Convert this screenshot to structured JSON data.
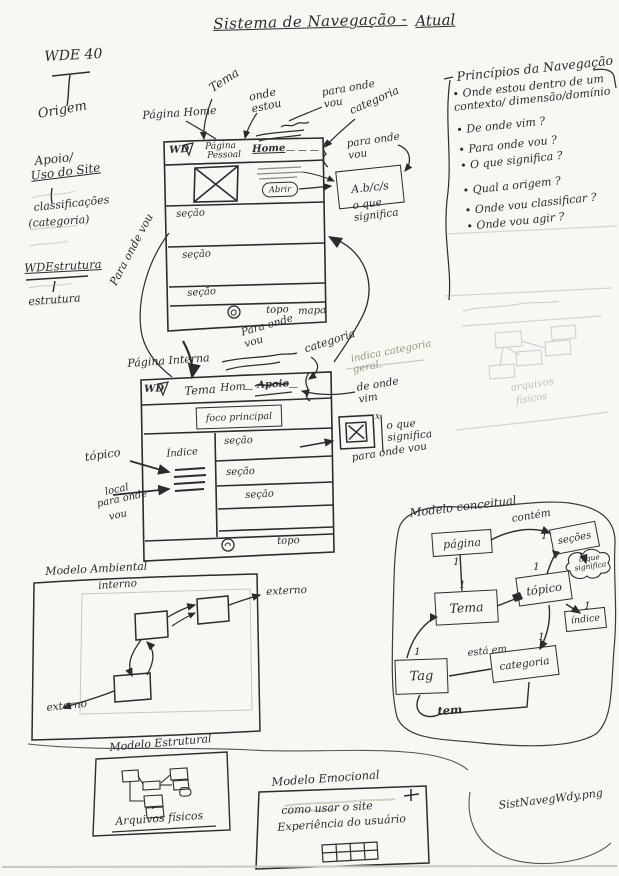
{
  "title": {
    "main": "Sistema de Navegação -",
    "atual": "Atual"
  },
  "left_margin": {
    "wde": "WDE 40",
    "origem": "Origem",
    "apoio": "Apoio/",
    "uso_site": "Uso do Site",
    "classificacoes": "classificações",
    "categoria": "(categoria)",
    "wdestrutura": "WDEstrutura",
    "estrutura": "estrutura",
    "para_onde_vou": "Para onde vou"
  },
  "principios": {
    "title": "Princípios da Navegação",
    "items": [
      "Onde estou dentro de um contexto/ dimensão/domínio",
      "De onde vim ?",
      "Para onde vou ?",
      "O que significa ?",
      "Qual a origem ?",
      "Onde vou classificar ?",
      "Onde vou agir ?"
    ]
  },
  "home": {
    "page_label": "Página Home",
    "logo": "WD",
    "nav_pagina": "Página",
    "nav_pessoal": "Pessoal",
    "nav_home": "Home",
    "nav_dashes": "— — —",
    "abrir": "Abrir",
    "sections": [
      "seção",
      "seção",
      "seção"
    ],
    "footer_topo": "topo",
    "footer_mapa": "mapa",
    "ann_tema": "Tema",
    "ann_onde_estou": "onde estou",
    "ann_para_onde_vou_1": "para onde vou",
    "ann_categoria": "categoria",
    "ann_para_onde_vou_2": "para onde vou",
    "breadcrumb": "A.b/c/s",
    "ann_o_que_significa": "o que significa"
  },
  "between": {
    "para_onde_vou": "Para onde vou",
    "categoria": "categoria",
    "indica": "indica categoria geral.",
    "de_onde_vim": "de onde vim"
  },
  "interna": {
    "page_label": "Página Interna",
    "logo": "WD",
    "nav_tema": "Tema",
    "nav_home": "Hom",
    "dash": "—",
    "nav_apoio": "Apoio",
    "foco": "foco principal",
    "indice": "Índice",
    "sections": [
      "seção",
      "seção",
      "seção"
    ],
    "footer_topo": "topo",
    "ann_topico": "tópico",
    "local": [
      "local",
      "para onde",
      "vou"
    ],
    "close_sup": "x",
    "ann_o_que_significa": "o que significa",
    "ann_para_onde_vou": "para onde vou"
  },
  "conceitual": {
    "title": "Modelo conceitual",
    "pagina": "página",
    "secoes": "seções",
    "tema": "Tema",
    "topico": "tópico",
    "indice": "índice",
    "tag": "Tag",
    "categoria": "categoria",
    "contem": "contém",
    "esta_em": "está em",
    "tem": "tem",
    "one": "1",
    "cloud": "o que significa"
  },
  "ambiental": {
    "title": "Modelo Ambiental",
    "interno": "interno",
    "externo_dir": "externo",
    "externo_esq": "externo"
  },
  "estrutural": {
    "title": "Modelo Estrutural",
    "arquivos": "Arquivos físicos"
  },
  "estrutural_pencil": {
    "arquivos": "arquivos",
    "fisicos": "físicos"
  },
  "emocional": {
    "title": "Modelo Emocional",
    "linha1": "como usar o site",
    "linha2": "Experiência do usuário",
    "plus": "+"
  },
  "file_note": "SistNavegWdy.png"
}
